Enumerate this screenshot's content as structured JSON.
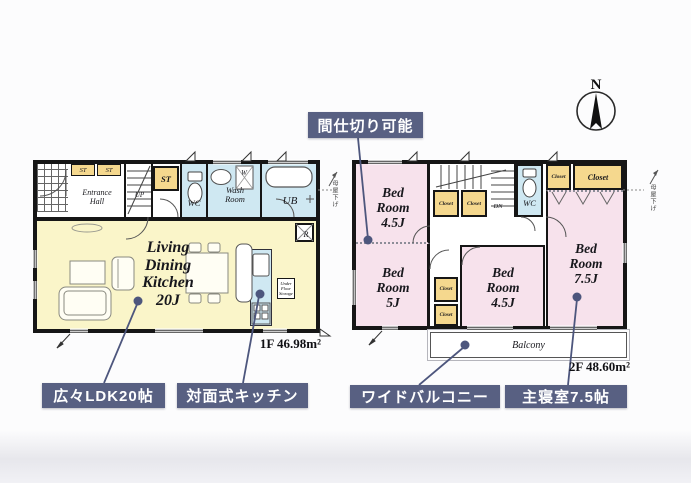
{
  "colors": {
    "wall": "#161616",
    "ldk_yellow": "#faf5c9",
    "closet_yellow": "#f5d88e",
    "water_blue": "#cfe8f2",
    "bedroom_pink": "#f7e2ec",
    "badge_bg": "#586082",
    "badge_text": "#ffffff",
    "leader": "#4d567d"
  },
  "compass": {
    "label": "N"
  },
  "callouts": {
    "partition": "間仕切り可能",
    "ldk": "広々LDK20帖",
    "kitchen": "対面式キッチン",
    "balcony": "ワイドバルコニー",
    "master": "主寝室7.5帖"
  },
  "floor1": {
    "area": "1F 46.98m²",
    "ldk": [
      "Living",
      "Dining",
      "Kitchen",
      "20J"
    ],
    "entrance": [
      "Entrance",
      "Hall"
    ],
    "up": "UP",
    "st": "ST",
    "wc": "WC",
    "wash": [
      "Wash",
      "Room"
    ],
    "ub": "UB",
    "washer": "W",
    "fridge": "R",
    "ufs": [
      "Under",
      "Floor",
      "Storage"
    ]
  },
  "floor2": {
    "area": "2F 48.60m²",
    "bed_a": [
      "Bed",
      "Room",
      "4.5J"
    ],
    "bed_b": [
      "Bed",
      "Room",
      "5J"
    ],
    "bed_c": [
      "Bed",
      "Room",
      "4.5J"
    ],
    "bed_d": [
      "Bed",
      "Room",
      "7.5J"
    ],
    "closet": "Closet",
    "wc": "WC",
    "dn": "DN",
    "balcony": "Balcony"
  },
  "notes": {
    "roof": "母屋下げ"
  }
}
